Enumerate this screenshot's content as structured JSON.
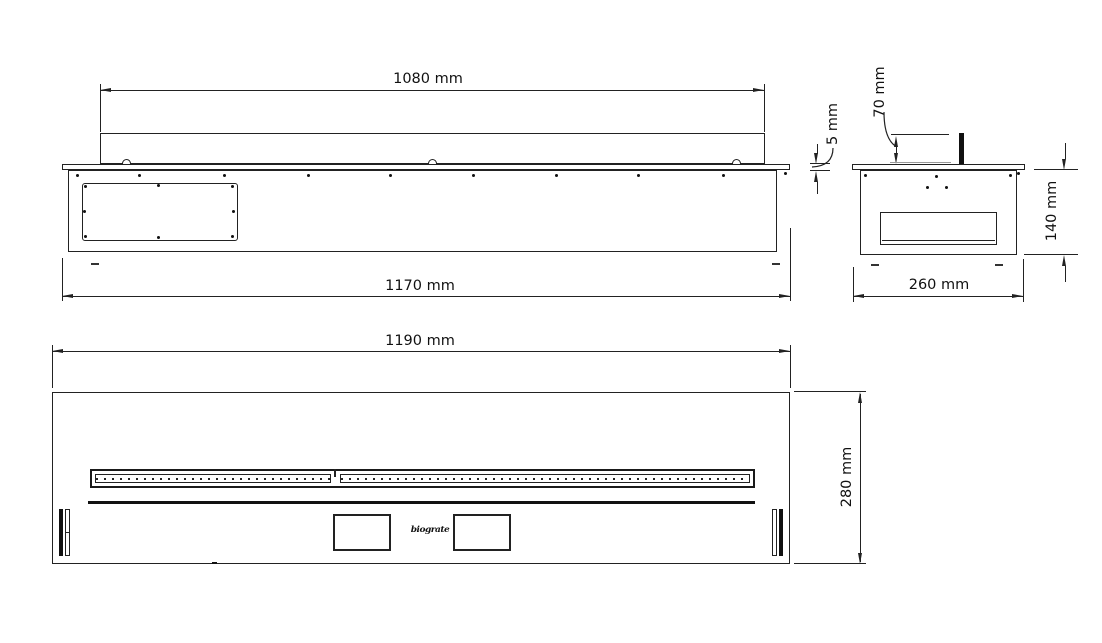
{
  "colors": {
    "line": "#222222",
    "background": "#ffffff",
    "text": "#111111"
  },
  "drawing": {
    "front_view": {
      "dim_top": "1080 mm",
      "dim_overall_width": "1170 mm",
      "dim_flange_thickness": "5 mm"
    },
    "side_view": {
      "dim_burner_height": "70 mm",
      "dim_body_height": "140 mm",
      "dim_depth": "260 mm"
    },
    "plan_view": {
      "dim_length": "1190 mm",
      "dim_width": "280 mm",
      "logo": "biograte"
    }
  }
}
